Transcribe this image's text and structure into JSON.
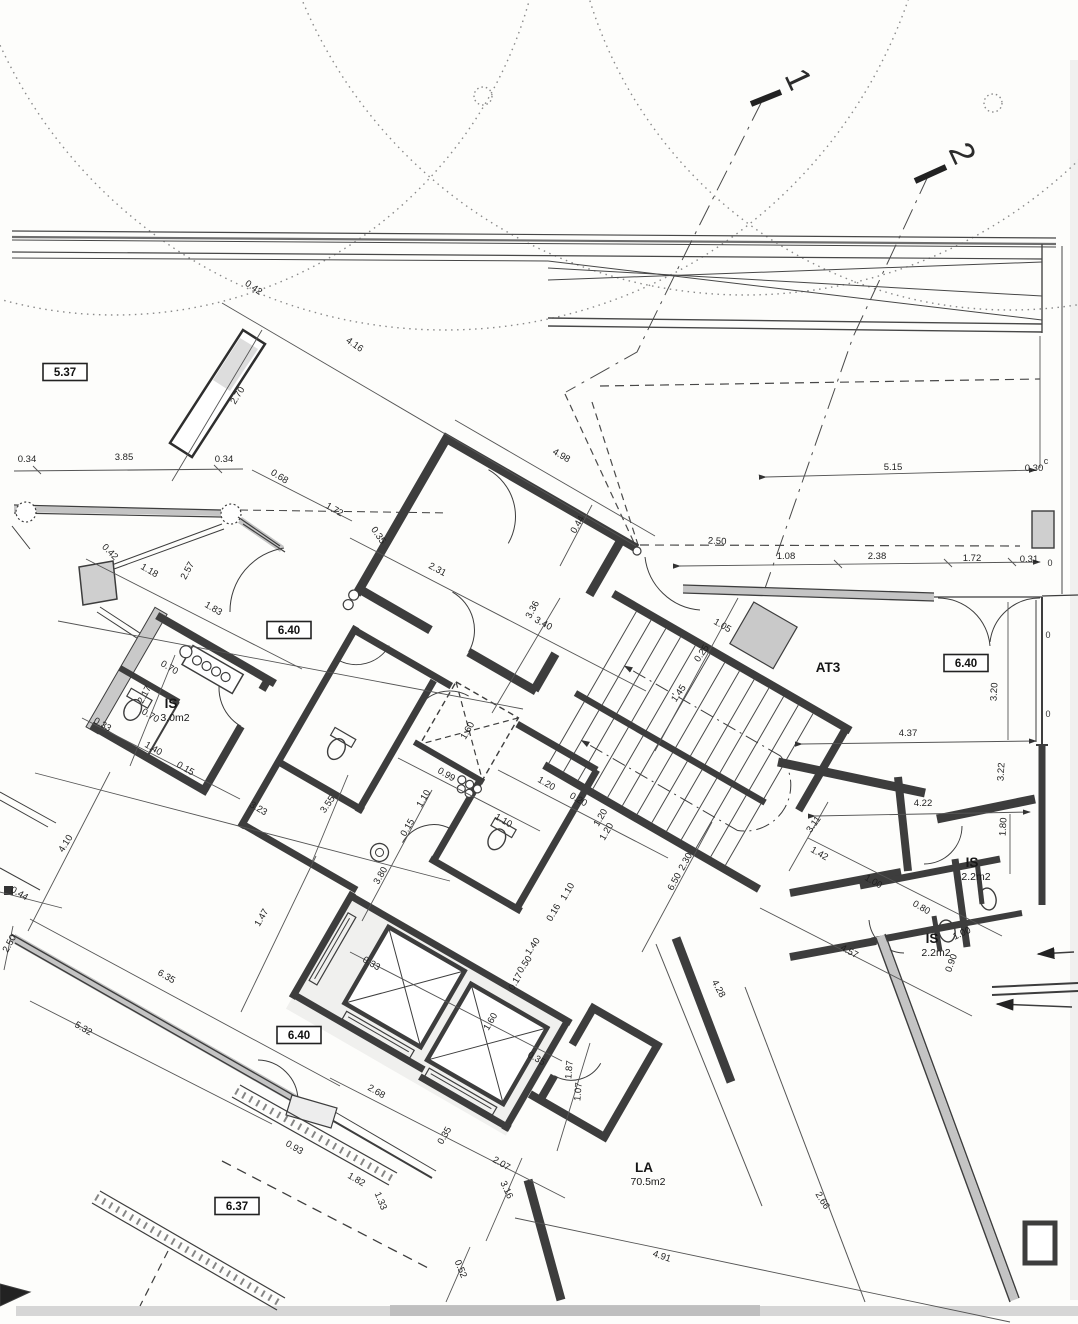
{
  "meta": {
    "kind": "scanned architectural floor plan"
  },
  "colors": {
    "paper": "#fdfdfb",
    "ink": "#3d3d3d",
    "thin": "#4a4a4a",
    "wall_gray": "#c6c6c6",
    "scan_band": "#c9c9c9"
  },
  "section_markers": [
    {
      "label": "1",
      "x": 788,
      "y": 84,
      "rot": 65
    },
    {
      "label": "2",
      "x": 952,
      "y": 158,
      "rot": 65
    }
  ],
  "boxed_levels": [
    {
      "value": "5.37",
      "x": 65,
      "y": 372
    },
    {
      "value": "6.40",
      "x": 289,
      "y": 630
    },
    {
      "value": "6.40",
      "x": 966,
      "y": 663
    },
    {
      "value": "6.40",
      "x": 299,
      "y": 1035
    },
    {
      "value": "6.37",
      "x": 237,
      "y": 1206
    }
  ],
  "rooms": [
    {
      "name": "IS",
      "area": "3.0m2",
      "x": 171,
      "y": 708
    },
    {
      "name": "AT3",
      "area": "",
      "x": 828,
      "y": 672
    },
    {
      "name": "IS",
      "area": "2.2m2",
      "x": 972,
      "y": 867
    },
    {
      "name": "IS",
      "area": "2.2m2",
      "x": 932,
      "y": 943
    },
    {
      "name": "LA",
      "area": "70.5m2",
      "x": 644,
      "y": 1172
    }
  ],
  "dimensions": [
    {
      "t": "0.42",
      "x": 252,
      "y": 290,
      "r": 35
    },
    {
      "t": "4.16",
      "x": 353,
      "y": 347,
      "r": 35
    },
    {
      "t": "2.70",
      "x": 240,
      "y": 397,
      "r": -58
    },
    {
      "t": "0.34",
      "x": 27,
      "y": 462,
      "r": 0
    },
    {
      "t": "3.85",
      "x": 124,
      "y": 460,
      "r": 0
    },
    {
      "t": "0.34",
      "x": 224,
      "y": 462,
      "r": 0
    },
    {
      "t": "0.68",
      "x": 278,
      "y": 479,
      "r": 32
    },
    {
      "t": "1.72",
      "x": 333,
      "y": 512,
      "r": 30
    },
    {
      "t": "0.35",
      "x": 376,
      "y": 537,
      "r": 55
    },
    {
      "t": "2.31",
      "x": 436,
      "y": 572,
      "r": 28
    },
    {
      "t": "4.98",
      "x": 560,
      "y": 458,
      "r": 30
    },
    {
      "t": "0.44",
      "x": 580,
      "y": 526,
      "r": -60
    },
    {
      "t": "3.36",
      "x": 535,
      "y": 611,
      "r": -62
    },
    {
      "t": "3.40",
      "x": 542,
      "y": 626,
      "r": 28
    },
    {
      "t": "0.42",
      "x": 108,
      "y": 554,
      "r": 45
    },
    {
      "t": "1.18",
      "x": 148,
      "y": 573,
      "r": 30
    },
    {
      "t": "2.57",
      "x": 190,
      "y": 572,
      "r": -62
    },
    {
      "t": "1.83",
      "x": 212,
      "y": 611,
      "r": 30
    },
    {
      "t": "2.17",
      "x": 147,
      "y": 696,
      "r": -62
    },
    {
      "t": "0.70",
      "x": 168,
      "y": 670,
      "r": 30
    },
    {
      "t": "0.70",
      "x": 149,
      "y": 718,
      "r": 30
    },
    {
      "t": "1.40",
      "x": 152,
      "y": 751,
      "r": 30
    },
    {
      "t": "0.33",
      "x": 101,
      "y": 727,
      "r": 30
    },
    {
      "t": "0.15",
      "x": 184,
      "y": 771,
      "r": 30
    },
    {
      "t": "3.23",
      "x": 257,
      "y": 811,
      "r": 30
    },
    {
      "t": "3.55",
      "x": 330,
      "y": 806,
      "r": -55
    },
    {
      "t": "4.10",
      "x": 68,
      "y": 845,
      "r": -58
    },
    {
      "t": "0.44",
      "x": 18,
      "y": 896,
      "r": 30
    },
    {
      "t": "2.50",
      "x": 12,
      "y": 945,
      "r": -62
    },
    {
      "t": "1.47",
      "x": 264,
      "y": 919,
      "r": -60
    },
    {
      "t": "6.35",
      "x": 165,
      "y": 979,
      "r": 30
    },
    {
      "t": "5.32",
      "x": 82,
      "y": 1031,
      "r": 30
    },
    {
      "t": "3.80",
      "x": 383,
      "y": 877,
      "r": -60
    },
    {
      "t": "0.15",
      "x": 410,
      "y": 829,
      "r": -60
    },
    {
      "t": "1.10",
      "x": 426,
      "y": 800,
      "r": -60
    },
    {
      "t": "0.99",
      "x": 445,
      "y": 777,
      "r": 30
    },
    {
      "t": "1.10",
      "x": 502,
      "y": 823,
      "r": 30
    },
    {
      "t": "1.10",
      "x": 570,
      "y": 893,
      "r": -60
    },
    {
      "t": "0.16",
      "x": 556,
      "y": 914,
      "r": -60
    },
    {
      "t": "1.60",
      "x": 470,
      "y": 732,
      "r": -60
    },
    {
      "t": "1.20",
      "x": 545,
      "y": 786,
      "r": 30
    },
    {
      "t": "0.20",
      "x": 577,
      "y": 802,
      "r": 30
    },
    {
      "t": "1.20",
      "x": 603,
      "y": 819,
      "r": -60
    },
    {
      "t": "1.20",
      "x": 609,
      "y": 833,
      "r": -60
    },
    {
      "t": "6.50",
      "x": 677,
      "y": 883,
      "r": -62
    },
    {
      "t": "2.30",
      "x": 688,
      "y": 863,
      "r": -62
    },
    {
      "t": "1.05",
      "x": 721,
      "y": 628,
      "r": 30
    },
    {
      "t": "0.25",
      "x": 704,
      "y": 655,
      "r": -55
    },
    {
      "t": "1.45",
      "x": 681,
      "y": 695,
      "r": -55
    },
    {
      "t": "2.50",
      "x": 717,
      "y": 544,
      "r": 3
    },
    {
      "t": "5.15",
      "x": 893,
      "y": 470,
      "r": 0
    },
    {
      "t": "0.30",
      "x": 1034,
      "y": 471,
      "r": 0
    },
    {
      "t": "1.08",
      "x": 786,
      "y": 559,
      "r": 0
    },
    {
      "t": "2.38",
      "x": 877,
      "y": 559,
      "r": 0
    },
    {
      "t": "1.72",
      "x": 972,
      "y": 561,
      "r": 0
    },
    {
      "t": "0.31",
      "x": 1029,
      "y": 562,
      "r": 0
    },
    {
      "t": "4.37",
      "x": 908,
      "y": 736,
      "r": 0
    },
    {
      "t": "3.20",
      "x": 997,
      "y": 692,
      "r": -87
    },
    {
      "t": "3.22",
      "x": 1004,
      "y": 772,
      "r": -87
    },
    {
      "t": "4.22",
      "x": 923,
      "y": 806,
      "r": 0
    },
    {
      "t": "1.80",
      "x": 1006,
      "y": 827,
      "r": -87
    },
    {
      "t": "3.11",
      "x": 816,
      "y": 826,
      "r": -55
    },
    {
      "t": "1.42",
      "x": 818,
      "y": 856,
      "r": 30
    },
    {
      "t": "1.00",
      "x": 872,
      "y": 884,
      "r": 30
    },
    {
      "t": "0.80",
      "x": 920,
      "y": 910,
      "r": 30
    },
    {
      "t": "1.00",
      "x": 963,
      "y": 936,
      "r": -25
    },
    {
      "t": "0.90",
      "x": 954,
      "y": 964,
      "r": -70
    },
    {
      "t": "4.57",
      "x": 848,
      "y": 954,
      "r": 28
    },
    {
      "t": "4.28",
      "x": 716,
      "y": 990,
      "r": 62
    },
    {
      "t": "2.66",
      "x": 820,
      "y": 1202,
      "r": 58
    },
    {
      "t": "2.68",
      "x": 375,
      "y": 1094,
      "r": 30
    },
    {
      "t": "0.35",
      "x": 447,
      "y": 1137,
      "r": -60
    },
    {
      "t": "2.07",
      "x": 500,
      "y": 1166,
      "r": 30
    },
    {
      "t": "3.16",
      "x": 504,
      "y": 1191,
      "r": 65
    },
    {
      "t": "0.93",
      "x": 293,
      "y": 1150,
      "r": 30
    },
    {
      "t": "1.82",
      "x": 355,
      "y": 1182,
      "r": 30
    },
    {
      "t": "1.33",
      "x": 378,
      "y": 1202,
      "r": 68
    },
    {
      "t": "0.52",
      "x": 458,
      "y": 1270,
      "r": 68
    },
    {
      "t": "4.91",
      "x": 661,
      "y": 1259,
      "r": 18
    },
    {
      "t": "1.87",
      "x": 572,
      "y": 1070,
      "r": -85
    },
    {
      "t": "1.07",
      "x": 581,
      "y": 1092,
      "r": -85
    },
    {
      "t": "0.33",
      "x": 370,
      "y": 966,
      "r": 30
    },
    {
      "t": "1.40",
      "x": 535,
      "y": 948,
      "r": -55
    },
    {
      "t": "0.50",
      "x": 527,
      "y": 966,
      "r": -55
    },
    {
      "t": "0.17",
      "x": 518,
      "y": 983,
      "r": -60
    },
    {
      "t": "1.60",
      "x": 493,
      "y": 1023,
      "r": -60
    },
    {
      "t": "0.35",
      "x": 535,
      "y": 1061,
      "r": 30
    }
  ],
  "edge_fragments": [
    {
      "t": "c",
      "x": 1046,
      "y": 464
    },
    {
      "t": "0",
      "x": 1050,
      "y": 566
    },
    {
      "t": "0",
      "x": 1048,
      "y": 638
    },
    {
      "t": "0",
      "x": 1048,
      "y": 717
    }
  ]
}
